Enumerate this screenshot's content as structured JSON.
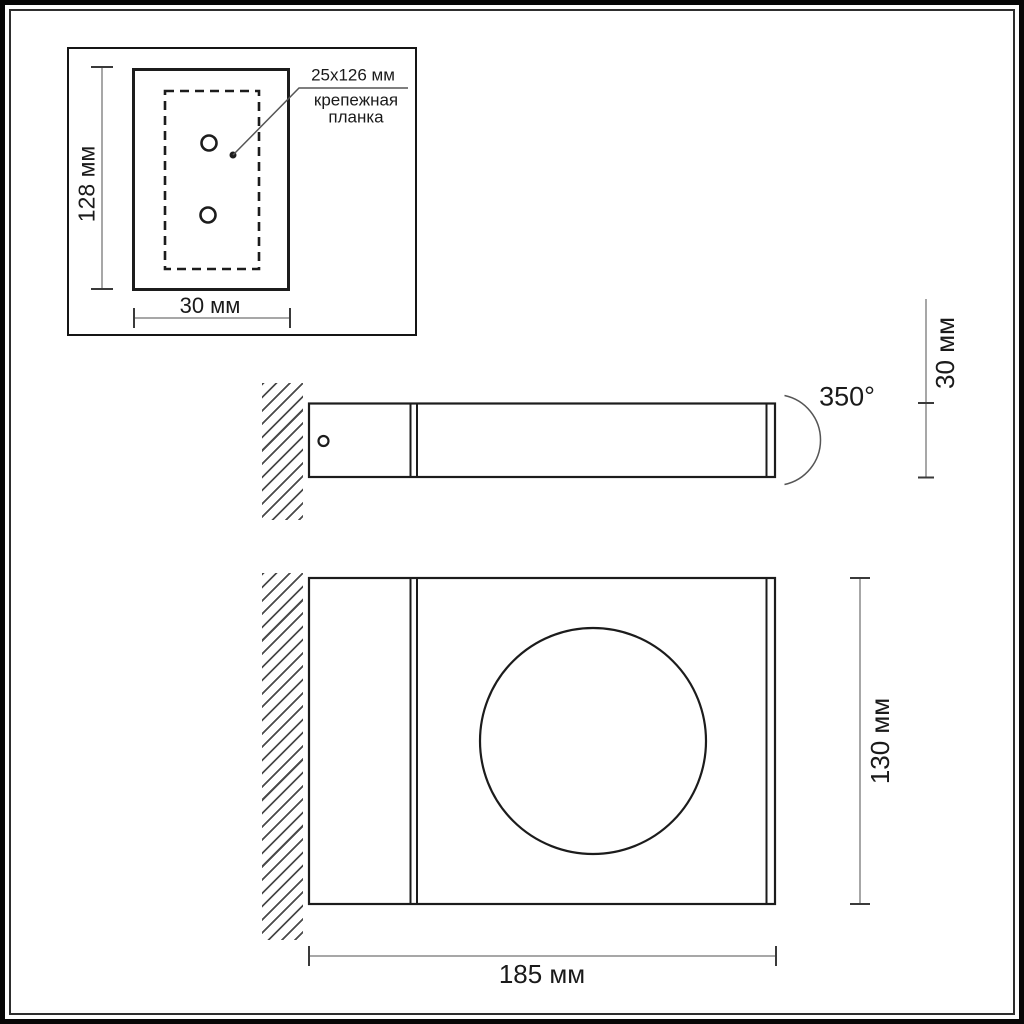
{
  "colors": {
    "background": "#ffffff",
    "line": "#1c1c1c",
    "dim_line": "#8a8a8a",
    "dim_cap": "#3a3a3a",
    "text": "#1a1a1a",
    "hatch": "#4a4a4a"
  },
  "inset": {
    "dim_height": "128 мм",
    "dim_width": "30 мм",
    "callout_size": "25x126 мм",
    "callout_label_line1": "крепежная",
    "callout_label_line2": "планка"
  },
  "side_view": {
    "rotation_angle": "350°",
    "dim_height": "30 мм"
  },
  "front_view": {
    "dim_height": "130 мм",
    "dim_width": "185 мм"
  }
}
